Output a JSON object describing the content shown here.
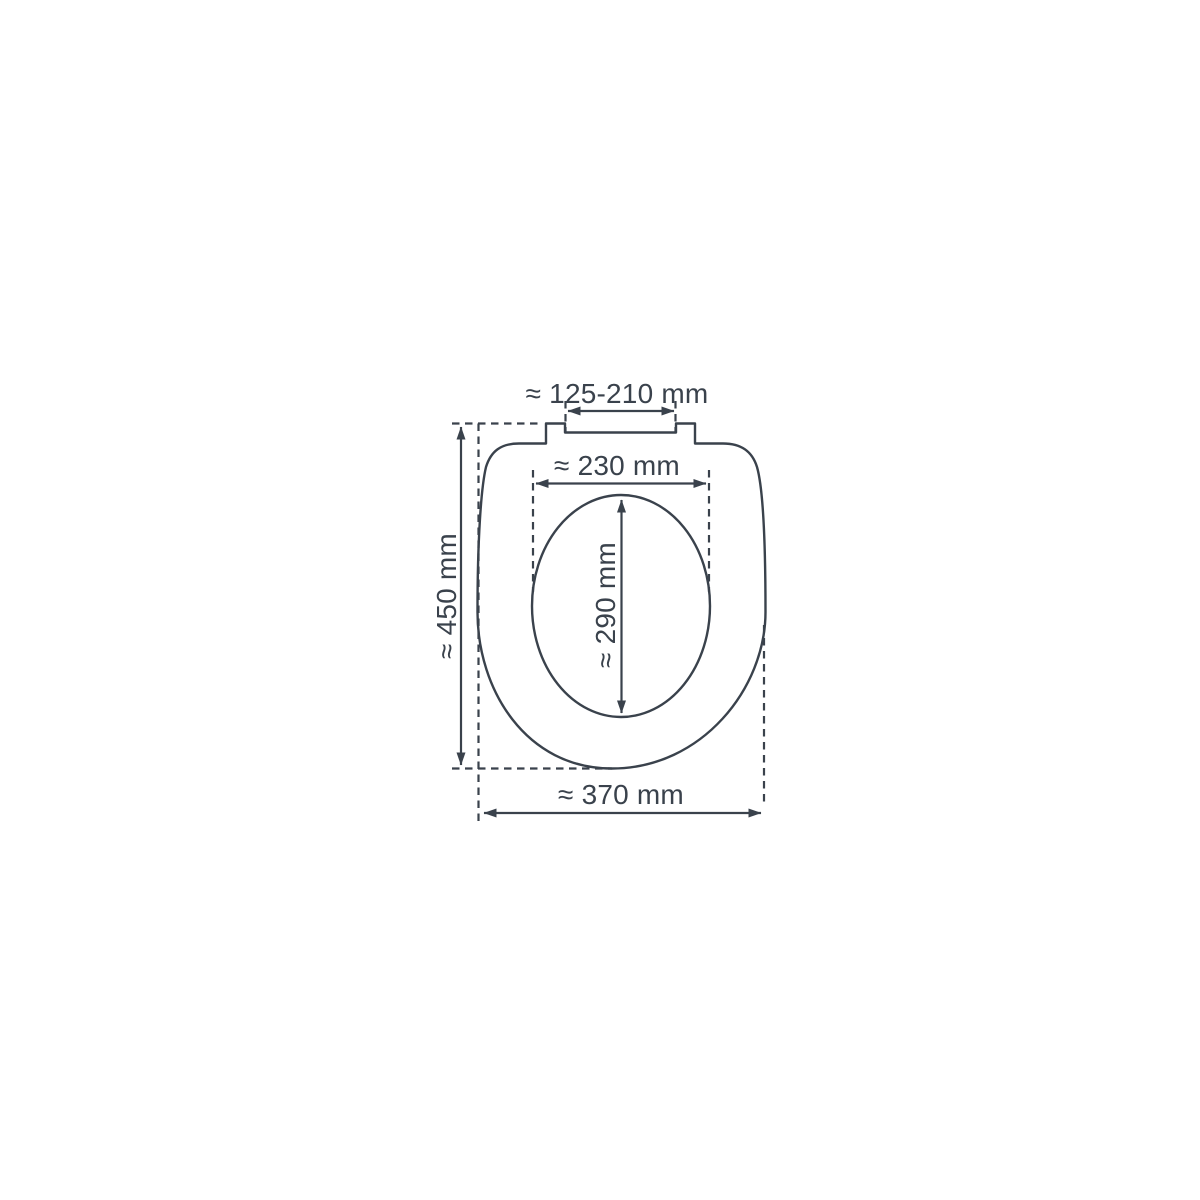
{
  "diagram": {
    "labels": {
      "hinge_width": "≈ 125-210 mm",
      "inner_width": "≈ 230 mm",
      "inner_length": "≈ 290 mm",
      "total_length": "≈ 450 mm",
      "outer_width": "≈ 370 mm"
    },
    "colors": {
      "line": "#3a424c",
      "background": "#ffffff"
    }
  }
}
